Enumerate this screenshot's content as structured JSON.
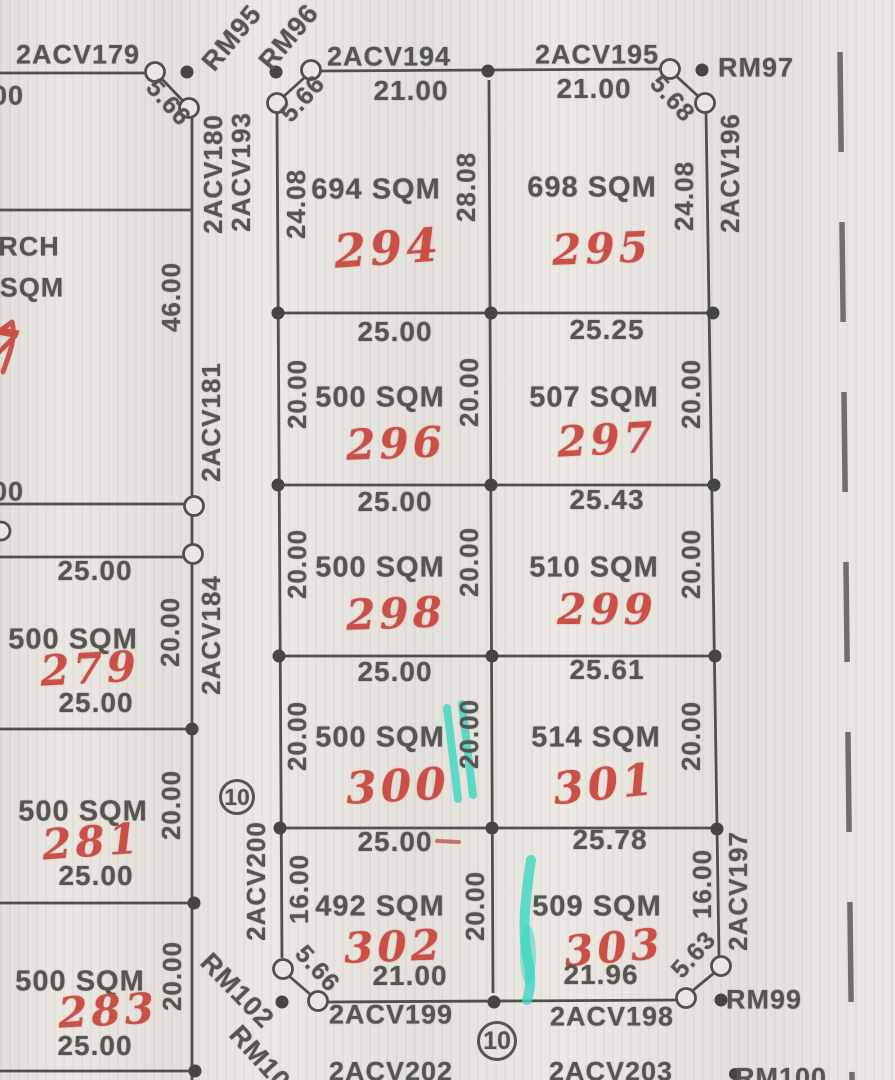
{
  "colors": {
    "paper": "#eae7e2",
    "ink": "#57554f",
    "red_pen": "#c94f47",
    "teal_highlighter": "#3ad8c2"
  },
  "parcels": [
    {
      "lot": "279",
      "area": "500 SQM"
    },
    {
      "lot": "281",
      "area": "500 SQM"
    },
    {
      "lot": "283",
      "area": "500 SQM"
    },
    {
      "lot": "294",
      "area": "694 SQM"
    },
    {
      "lot": "295",
      "area": "698 SQM"
    },
    {
      "lot": "296",
      "area": "500 SQM"
    },
    {
      "lot": "297",
      "area": "507 SQM"
    },
    {
      "lot": "298",
      "area": "500 SQM"
    },
    {
      "lot": "299",
      "area": "510 SQM"
    },
    {
      "lot": "300",
      "area": "500 SQM"
    },
    {
      "lot": "301",
      "area": "514 SQM"
    },
    {
      "lot": "302",
      "area": "492 SQM"
    },
    {
      "lot": "303",
      "area": "509 SQM"
    }
  ],
  "survey_markers": [
    "2ACV179",
    "2ACV180",
    "2ACV181",
    "2ACV184",
    "2ACV193",
    "2ACV194",
    "2ACV195",
    "2ACV196",
    "2ACV197",
    "2ACV198",
    "2ACV199",
    "2ACV200",
    "2ACV202",
    "2ACV203",
    "RM95",
    "RM96",
    "RM97",
    "RM99",
    "RM100",
    "RM101",
    "RM102"
  ],
  "circled": [
    {
      "id": "block-number-10-left",
      "text": "10",
      "x": 237,
      "y": 797,
      "d": 36,
      "size": 23
    },
    {
      "id": "block-number-10-bottom",
      "text": "10",
      "x": 497,
      "y": 1041,
      "d": 40,
      "size": 25
    }
  ],
  "labels": [
    {
      "id": "marker-2acv179",
      "text": "2ACV179",
      "x": 78,
      "y": 55,
      "size": 27
    },
    {
      "id": "dim-partial-top-left",
      "text": "00",
      "x": 8,
      "y": 96,
      "size": 27
    },
    {
      "id": "marker-rm95",
      "text": "RM95",
      "x": 232,
      "y": 38,
      "rot": -50,
      "size": 27
    },
    {
      "id": "marker-rm96",
      "text": "RM96",
      "x": 289,
      "y": 37,
      "rot": -50,
      "size": 27
    },
    {
      "id": "dim-5-66-nw",
      "text": "5.66",
      "x": 168,
      "y": 103,
      "rot": 48,
      "size": 25
    },
    {
      "id": "dim-5-66-top",
      "text": "5.66",
      "x": 303,
      "y": 99,
      "rot": -48,
      "size": 25
    },
    {
      "id": "marker-2acv194",
      "text": "2ACV194",
      "x": 389,
      "y": 57,
      "size": 27
    },
    {
      "id": "marker-2acv195",
      "text": "2ACV195",
      "x": 597,
      "y": 55,
      "size": 27
    },
    {
      "id": "marker-rm97",
      "text": "RM97",
      "x": 756,
      "y": 68,
      "size": 27
    },
    {
      "id": "dim-5-68",
      "text": "5.68",
      "x": 672,
      "y": 99,
      "rot": 48,
      "size": 25
    },
    {
      "id": "dim-21-lot294",
      "text": "21.00",
      "x": 411,
      "y": 91,
      "size": 28
    },
    {
      "id": "dim-21-lot295",
      "text": "21.00",
      "x": 594,
      "y": 89,
      "size": 28
    },
    {
      "id": "marker-2acv180",
      "text": "2ACV180",
      "x": 213,
      "y": 174,
      "rot": -90,
      "size": 26
    },
    {
      "id": "marker-2acv193",
      "text": "2ACV193",
      "x": 241,
      "y": 172,
      "rot": -90,
      "size": 26
    },
    {
      "id": "dim-24-08-w",
      "text": "24.08",
      "x": 296,
      "y": 204,
      "rot": -90,
      "size": 26
    },
    {
      "id": "dim-28-08",
      "text": "28.08",
      "x": 466,
      "y": 187,
      "rot": -90,
      "size": 26
    },
    {
      "id": "area-lot294",
      "text": "694 SQM",
      "x": 376,
      "y": 190,
      "size": 29
    },
    {
      "id": "lot-294",
      "text": "294",
      "x": 388,
      "y": 248,
      "cls": "red",
      "size": 46,
      "rot": -4
    },
    {
      "id": "area-lot295",
      "text": "698 SQM",
      "x": 592,
      "y": 188,
      "size": 29
    },
    {
      "id": "lot-295",
      "text": "295",
      "x": 602,
      "y": 249,
      "cls": "red",
      "size": 42,
      "rot": -2
    },
    {
      "id": "dim-24-08-e",
      "text": "24.08",
      "x": 684,
      "y": 196,
      "rot": -90,
      "size": 26
    },
    {
      "id": "marker-2acv196",
      "text": "2ACV196",
      "x": 730,
      "y": 173,
      "rot": -90,
      "size": 26
    },
    {
      "id": "text-partial-rch",
      "text": "RCH",
      "x": 29,
      "y": 247,
      "size": 27
    },
    {
      "id": "text-partial-sqm",
      "text": "SQM",
      "x": 32,
      "y": 288,
      "size": 27
    },
    {
      "id": "dim-46-00",
      "text": "46.00",
      "x": 171,
      "y": 297,
      "rot": -90,
      "size": 26
    },
    {
      "id": "marker-2acv181",
      "text": "2ACV181",
      "x": 211,
      "y": 422,
      "rot": -90,
      "size": 26
    },
    {
      "id": "lot-partial-left-edge",
      "text": "7",
      "x": 0,
      "y": 348,
      "cls": "red",
      "size": 54,
      "rot": 10
    },
    {
      "id": "dim-25-lot296-top",
      "text": "25.00",
      "x": 395,
      "y": 332,
      "size": 28
    },
    {
      "id": "dim-25-25",
      "text": "25.25",
      "x": 607,
      "y": 330,
      "size": 28
    },
    {
      "id": "dim-20-lot296-w",
      "text": "20.00",
      "x": 297,
      "y": 394,
      "rot": -90,
      "size": 26
    },
    {
      "id": "dim-20-lot296-e",
      "text": "20.00",
      "x": 469,
      "y": 392,
      "rot": -90,
      "size": 26
    },
    {
      "id": "dim-20-lot297-e",
      "text": "20.00",
      "x": 691,
      "y": 394,
      "rot": -90,
      "size": 26
    },
    {
      "id": "area-lot296",
      "text": "500 SQM",
      "x": 380,
      "y": 398,
      "size": 29
    },
    {
      "id": "lot-296",
      "text": "296",
      "x": 396,
      "y": 444,
      "cls": "red",
      "size": 42,
      "rot": -2
    },
    {
      "id": "area-lot297",
      "text": "507 SQM",
      "x": 594,
      "y": 398,
      "size": 29
    },
    {
      "id": "lot-297",
      "text": "297",
      "x": 607,
      "y": 440,
      "cls": "red",
      "size": 42,
      "rot": -3
    },
    {
      "id": "dim-25-lot298-top",
      "text": "25.00",
      "x": 395,
      "y": 502,
      "size": 28
    },
    {
      "id": "dim-25-43",
      "text": "25.43",
      "x": 607,
      "y": 500,
      "size": 28
    },
    {
      "id": "dim-20-lot298-w",
      "text": "20.00",
      "x": 297,
      "y": 564,
      "rot": -90,
      "size": 26
    },
    {
      "id": "dim-20-lot298-e",
      "text": "20.00",
      "x": 469,
      "y": 562,
      "rot": -90,
      "size": 26
    },
    {
      "id": "dim-20-lot299-e",
      "text": "20.00",
      "x": 691,
      "y": 564,
      "rot": -90,
      "size": 26
    },
    {
      "id": "area-lot298",
      "text": "500 SQM",
      "x": 380,
      "y": 568,
      "size": 29
    },
    {
      "id": "lot-298",
      "text": "298",
      "x": 396,
      "y": 614,
      "cls": "red",
      "size": 42,
      "rot": -2
    },
    {
      "id": "area-lot299",
      "text": "510 SQM",
      "x": 594,
      "y": 568,
      "size": 29
    },
    {
      "id": "lot-299",
      "text": "299",
      "x": 607,
      "y": 610,
      "cls": "red",
      "size": 42
    },
    {
      "id": "dim-partial-mid-left",
      "text": "00",
      "x": 8,
      "y": 492,
      "size": 27
    },
    {
      "id": "dim-25-lot279-top",
      "text": "25.00",
      "x": 95,
      "y": 571,
      "size": 28
    },
    {
      "id": "area-lot279",
      "text": "500 SQM",
      "x": 73,
      "y": 640,
      "size": 29
    },
    {
      "id": "lot-279",
      "text": "279",
      "x": 90,
      "y": 669,
      "cls": "red",
      "size": 42,
      "rot": -3
    },
    {
      "id": "dim-25-lot279-bottom",
      "text": "25.00",
      "x": 96,
      "y": 703,
      "size": 28
    },
    {
      "id": "dim-20-lot279",
      "text": "20.00",
      "x": 170,
      "y": 632,
      "rot": -90,
      "size": 26
    },
    {
      "id": "marker-2acv184",
      "text": "2ACV184",
      "x": 211,
      "y": 635,
      "rot": -90,
      "size": 26
    },
    {
      "id": "dim-25-lot300-top",
      "text": "25.00",
      "x": 395,
      "y": 672,
      "size": 28
    },
    {
      "id": "dim-25-61",
      "text": "25.61",
      "x": 607,
      "y": 670,
      "size": 28
    },
    {
      "id": "dim-20-lot300-w",
      "text": "20.00",
      "x": 297,
      "y": 736,
      "rot": -90,
      "size": 26
    },
    {
      "id": "dim-20-lot300-e",
      "text": "20.00",
      "x": 469,
      "y": 734,
      "rot": -90,
      "size": 26
    },
    {
      "id": "dim-20-lot301-e",
      "text": "20.00",
      "x": 691,
      "y": 736,
      "rot": -90,
      "size": 26
    },
    {
      "id": "area-lot300",
      "text": "500 SQM",
      "x": 380,
      "y": 738,
      "size": 29
    },
    {
      "id": "lot-300",
      "text": "300",
      "x": 398,
      "y": 787,
      "cls": "red",
      "size": 44,
      "rot": -3
    },
    {
      "id": "area-lot301",
      "text": "514 SQM",
      "x": 596,
      "y": 738,
      "size": 29
    },
    {
      "id": "lot-301",
      "text": "301",
      "x": 605,
      "y": 785,
      "cls": "red",
      "size": 44,
      "rot": -6
    },
    {
      "id": "area-lot281",
      "text": "500 SQM",
      "x": 83,
      "y": 812,
      "size": 29
    },
    {
      "id": "lot-281",
      "text": "281",
      "x": 92,
      "y": 842,
      "cls": "red",
      "size": 42,
      "rot": -4
    },
    {
      "id": "dim-25-lot281-bottom",
      "text": "25.00",
      "x": 96,
      "y": 876,
      "size": 28
    },
    {
      "id": "dim-20-lot281",
      "text": "20.00",
      "x": 171,
      "y": 805,
      "rot": -90,
      "size": 26
    },
    {
      "id": "marker-2acv200",
      "text": "2ACV200",
      "x": 256,
      "y": 881,
      "rot": -90,
      "size": 26
    },
    {
      "id": "dim-25-lot302-top",
      "text": "25.00",
      "x": 395,
      "y": 842,
      "size": 28
    },
    {
      "id": "dim-25-78",
      "text": "25.78",
      "x": 610,
      "y": 840,
      "size": 28
    },
    {
      "id": "dim-16-lot302-w",
      "text": "16.00",
      "x": 299,
      "y": 889,
      "rot": -90,
      "size": 26
    },
    {
      "id": "dim-20-lot302-e",
      "text": "20.00",
      "x": 475,
      "y": 906,
      "rot": -90,
      "size": 26
    },
    {
      "id": "dim-16-lot303-e",
      "text": "16.00",
      "x": 702,
      "y": 884,
      "rot": -90,
      "size": 26
    },
    {
      "id": "area-lot302",
      "text": "492 SQM",
      "x": 380,
      "y": 907,
      "size": 29
    },
    {
      "id": "lot-302",
      "text": "302",
      "x": 394,
      "y": 947,
      "cls": "red",
      "size": 42,
      "rot": -2
    },
    {
      "id": "area-lot303",
      "text": "509 SQM",
      "x": 597,
      "y": 907,
      "size": 29
    },
    {
      "id": "lot-303",
      "text": "303",
      "x": 614,
      "y": 948,
      "cls": "red",
      "size": 42,
      "rot": -5
    },
    {
      "id": "dim-21-lot302-bottom",
      "text": "21.00",
      "x": 410,
      "y": 976,
      "size": 28
    },
    {
      "id": "dim-21-96",
      "text": "21.96",
      "x": 601,
      "y": 975,
      "size": 28
    },
    {
      "id": "dim-5-66-sw",
      "text": "5.66",
      "x": 317,
      "y": 969,
      "rot": 48,
      "size": 25
    },
    {
      "id": "dim-5-63",
      "text": "5.63",
      "x": 694,
      "y": 955,
      "rot": -48,
      "size": 25
    },
    {
      "id": "marker-2acv197",
      "text": "2ACV197",
      "x": 738,
      "y": 891,
      "rot": -90,
      "size": 26
    },
    {
      "id": "area-lot283",
      "text": "500 SQM",
      "x": 80,
      "y": 982,
      "size": 29
    },
    {
      "id": "lot-283",
      "text": "283",
      "x": 108,
      "y": 1011,
      "cls": "red",
      "size": 42,
      "rot": -3
    },
    {
      "id": "dim-25-lot283-bottom",
      "text": "25.00",
      "x": 95,
      "y": 1046,
      "size": 28
    },
    {
      "id": "dim-20-lot283",
      "text": "20.00",
      "x": 172,
      "y": 976,
      "rot": -90,
      "size": 26
    },
    {
      "id": "marker-rm102",
      "text": "RM102",
      "x": 237,
      "y": 991,
      "rot": 46,
      "size": 27
    },
    {
      "id": "marker-rm101",
      "text": "RM101",
      "x": 265,
      "y": 1064,
      "rot": 48,
      "size": 27
    },
    {
      "id": "marker-2acv199",
      "text": "2ACV199",
      "x": 391,
      "y": 1015,
      "size": 27
    },
    {
      "id": "marker-2acv198",
      "text": "2ACV198",
      "x": 612,
      "y": 1017,
      "size": 27
    },
    {
      "id": "marker-rm99",
      "text": "RM99",
      "x": 764,
      "y": 1000,
      "size": 27
    },
    {
      "id": "marker-2acv202",
      "text": "2ACV202",
      "x": 391,
      "y": 1072,
      "size": 27
    },
    {
      "id": "marker-2acv203",
      "text": "2ACV203",
      "x": 611,
      "y": 1072,
      "size": 27
    },
    {
      "id": "marker-rm100",
      "text": "RM100",
      "x": 781,
      "y": 1078,
      "size": 27
    }
  ]
}
